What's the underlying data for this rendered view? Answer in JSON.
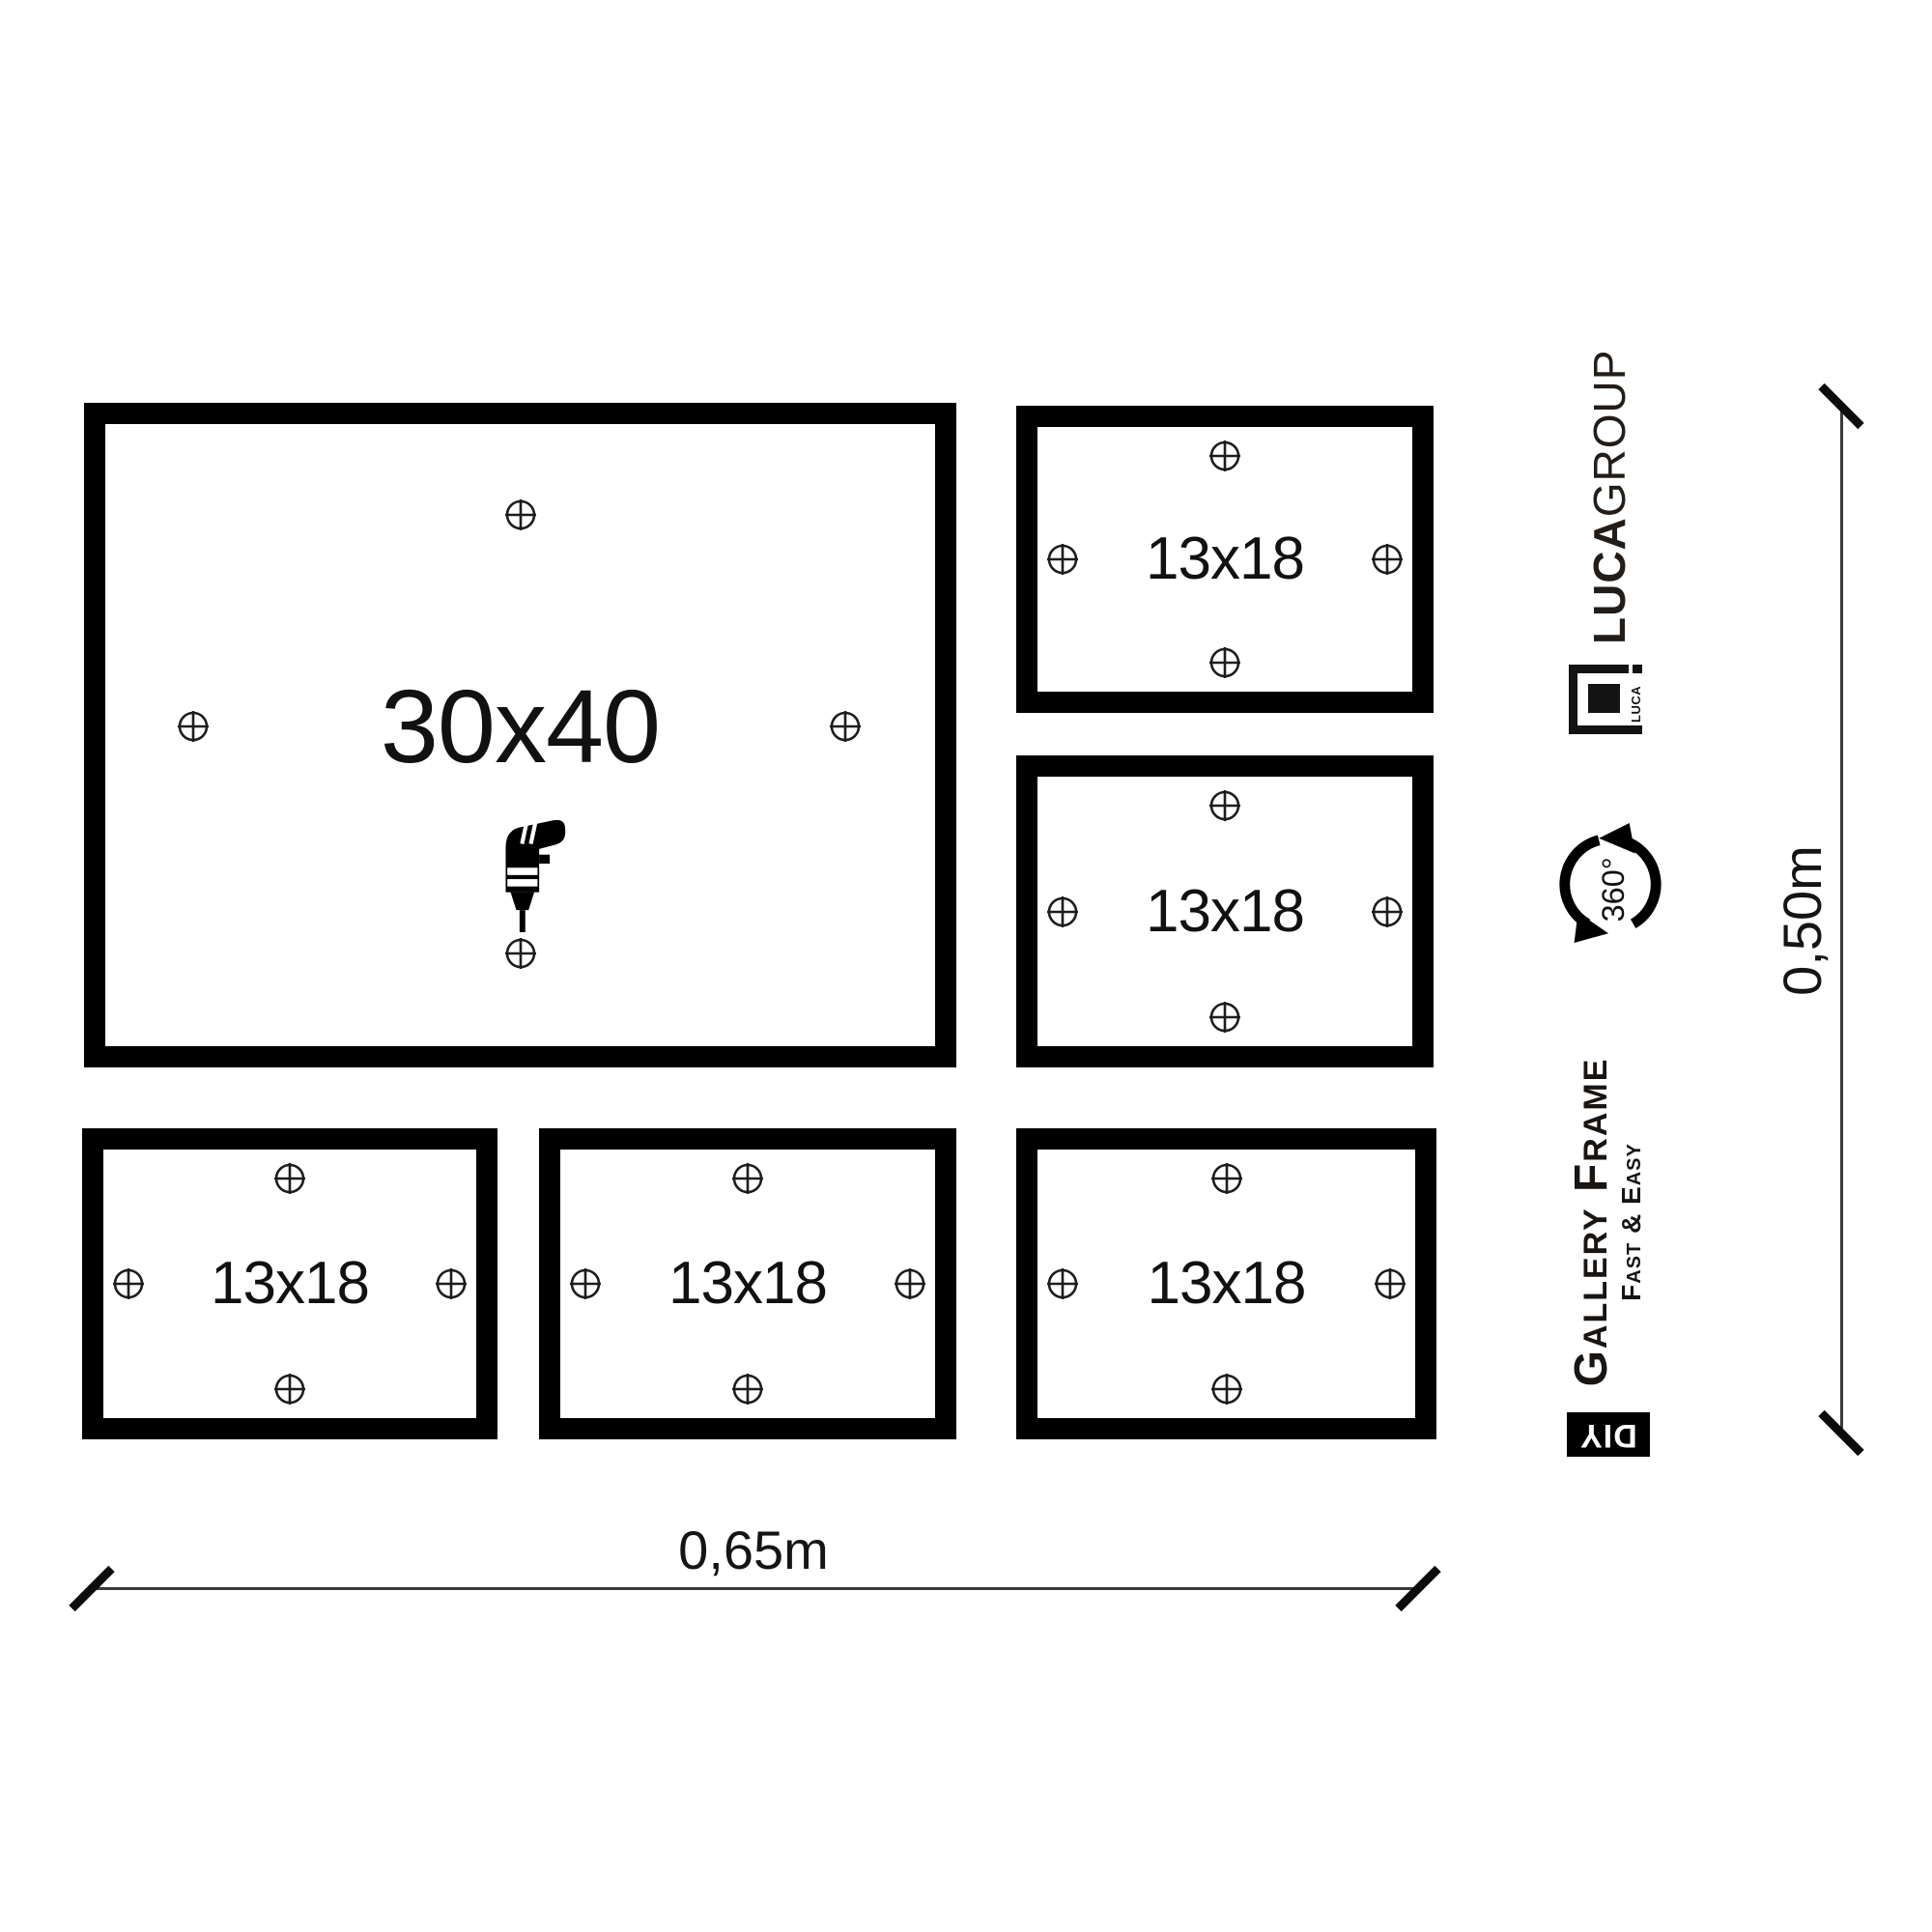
{
  "frames": [
    {
      "size_label": "30x40"
    },
    {
      "size_label": "13x18"
    },
    {
      "size_label": "13x18"
    },
    {
      "size_label": "13x18"
    },
    {
      "size_label": "13x18"
    },
    {
      "size_label": "13x18"
    }
  ],
  "dimensions": {
    "horizontal_label": "0,65m",
    "vertical_label": "0,50m"
  },
  "branding": {
    "brand_bold": "LUCA",
    "brand_light": "GROUP",
    "logo_text": "LUCA",
    "rotation_badge": "360°",
    "product_name": "Gallery Frame",
    "product_tagline": "Fast & Easy",
    "diy_label": "DIY"
  },
  "icons": {
    "drill": "drill-icon",
    "mount_mark": "crosshair-mark-icon",
    "rotation": "rotation-360-icon",
    "logo": "luca-frame-logo-icon"
  },
  "colors": {
    "frame": "#000000",
    "ink": "#141414",
    "background": "#ffffff"
  }
}
